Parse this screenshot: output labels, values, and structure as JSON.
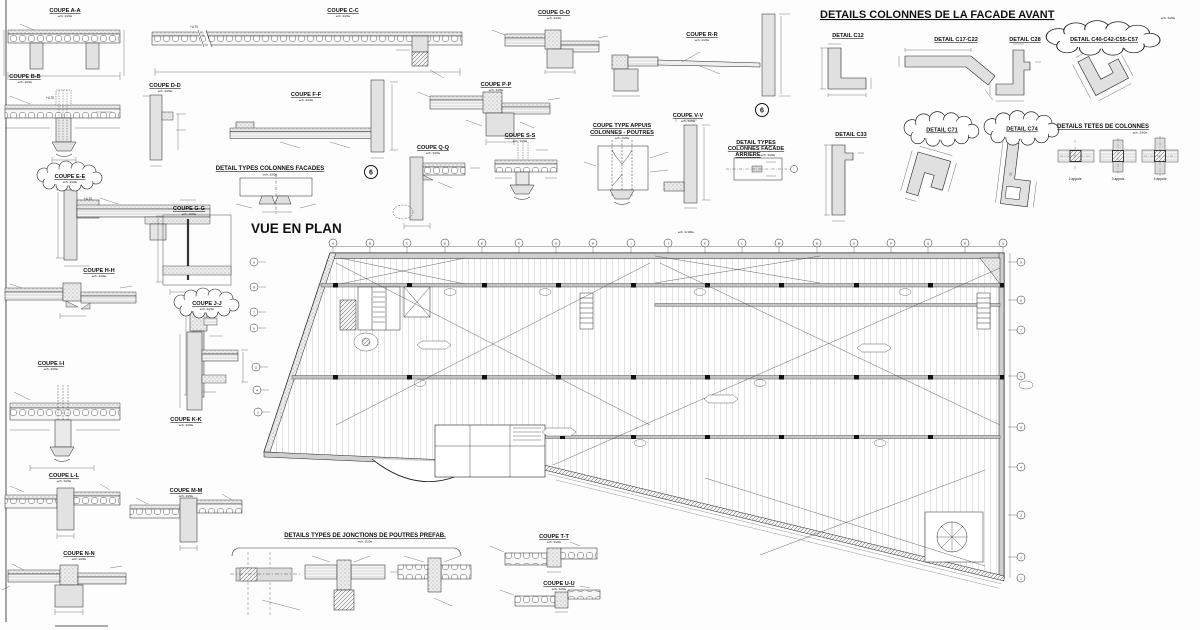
{
  "sheet_type": "structural drawing sheet",
  "colors": {
    "line": "#1a1a1a",
    "concrete_grey": "#e0e0e0",
    "beam_grey": "#c4c4c4",
    "paper": "#fdfdfd"
  },
  "group_titles": {
    "facade_avant": {
      "title": "DETAILS COLONNES DE LA FACADE AVANT",
      "scale": "ech.:1/20e"
    },
    "vue_en_plan": {
      "title": "VUE EN PLAN",
      "scale": "ech.:1/100e"
    },
    "jonctions": {
      "title": "DETAILS TYPES DE JONCTIONS DE POUTRES PREFAB.",
      "scale": "ech.:1/20e"
    },
    "tetes": {
      "title": "DETAILS TETES DE COLONNES",
      "scale": "ech.:1/50e"
    },
    "colonnes_facades": {
      "title": "DETAIL TYPES COLONNES FACADES",
      "scale": "ech.:1/50e"
    },
    "facade_arriere": {
      "line1": "DETAIL TYPES",
      "line2": "COLONNES FACADE",
      "line3": "ARRIERE",
      "scale": "ech.:1/20e"
    }
  },
  "coupes": {
    "aa": {
      "title": "COUPE A-A",
      "scale": "ech.:1/20e"
    },
    "bb": {
      "title": "COUPE B-B",
      "scale": "ech.:1/20e"
    },
    "cc": {
      "title": "COUPE C-C",
      "scale": "ech.:1/20e"
    },
    "dd": {
      "title": "COUPE D-D",
      "scale": "ech.:1/20e"
    },
    "ee": {
      "title": "COUPE E-E",
      "scale": "ech.:1/20e"
    },
    "ff": {
      "title": "COUPE F-F",
      "scale": "ech.:1/20e"
    },
    "gg": {
      "title": "COUPE G-G",
      "scale": "ech.:1/20e"
    },
    "hh": {
      "title": "COUPE H-H",
      "scale": "ech.:1/20e"
    },
    "ii": {
      "title": "COUPE I-I",
      "scale": "ech.:1/20e"
    },
    "jj": {
      "title": "COUPE J-J",
      "scale": "ech.:1/20e"
    },
    "kk": {
      "title": "COUPE K-K",
      "scale": "ech.:1/20e"
    },
    "ll": {
      "title": "COUPE L-L",
      "scale": "ech.:1/20e"
    },
    "mm": {
      "title": "COUPE M-M",
      "scale": "ech.:1/20e"
    },
    "nn": {
      "title": "COUPE N-N",
      "scale": "ech.:1/20e"
    },
    "oo": {
      "title": "COUPE O-O",
      "scale": "ech.:1/20e"
    },
    "pp": {
      "title": "COUPE P-P",
      "scale": "ech.:1/20e"
    },
    "qq": {
      "title": "COUPE Q-Q",
      "scale": "ech.:1/20e"
    },
    "rr": {
      "title": "COUPE R-R",
      "scale": "ech.:1/20e"
    },
    "ss": {
      "title": "COUPE S-S",
      "scale": "ech.:1/20e"
    },
    "tt": {
      "title": "COUPE T-T",
      "scale": "ech.:1/20e"
    },
    "uu": {
      "title": "COUPE U-U",
      "scale": "ech.:1/20e"
    },
    "vv": {
      "title": "COUPE V-V",
      "scale": "ech.:1/20e"
    }
  },
  "coupe_type_appuis": {
    "line1": "COUPE TYPE APPUIS",
    "line2": "COLONNES - POUTRES",
    "scale": "ech.:1/20e"
  },
  "details": {
    "c12": "DETAIL C12",
    "c17": "DETAIL C17-C22",
    "c28": "DETAIL C28",
    "c40": "DETAIL C40-C42-C55-C57",
    "c33": "DETAIL C33",
    "c71": "DETAIL C71",
    "c74": "DETAIL C74"
  },
  "tetes_labels": [
    "2 appuis",
    "3 appuis",
    "4 appuis"
  ],
  "markers": {
    "ref_bubble": "6"
  },
  "elevations": {
    "e1": "+4.70",
    "e2": "+4.70",
    "e3": "+4.70"
  },
  "plan": {
    "grid_letters": [
      "A",
      "B",
      "C",
      "D",
      "E",
      "F",
      "G",
      "H",
      "I",
      "J",
      "K",
      "L",
      "M",
      "N",
      "O",
      "P",
      "Q",
      "R",
      "S"
    ],
    "grid_rows_right": [
      "9",
      "8",
      "7",
      "6",
      "5",
      "4",
      "3",
      "2",
      "1"
    ],
    "grid_rows_left": [
      "9",
      "8",
      "7",
      "6",
      "5",
      "4",
      "3"
    ]
  }
}
